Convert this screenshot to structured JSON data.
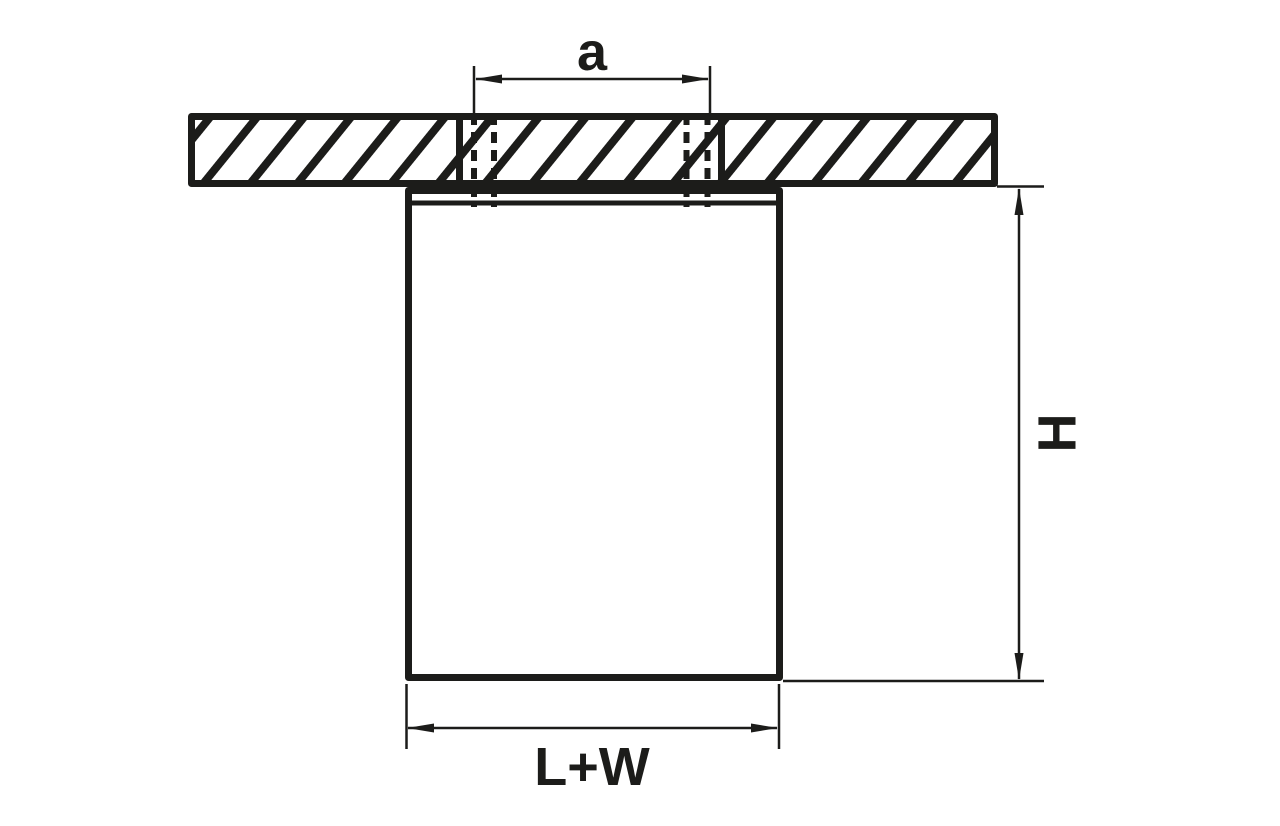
{
  "diagram": {
    "kind": "ceiling-mounted luminaire installation dimension drawing",
    "dimensions": {
      "mounting_hole_spacing": "a",
      "fixture_height": "H",
      "fixture_footprint": "L+W"
    },
    "colors": {
      "line": "#1c1c1a",
      "background": "#ffffff"
    }
  }
}
